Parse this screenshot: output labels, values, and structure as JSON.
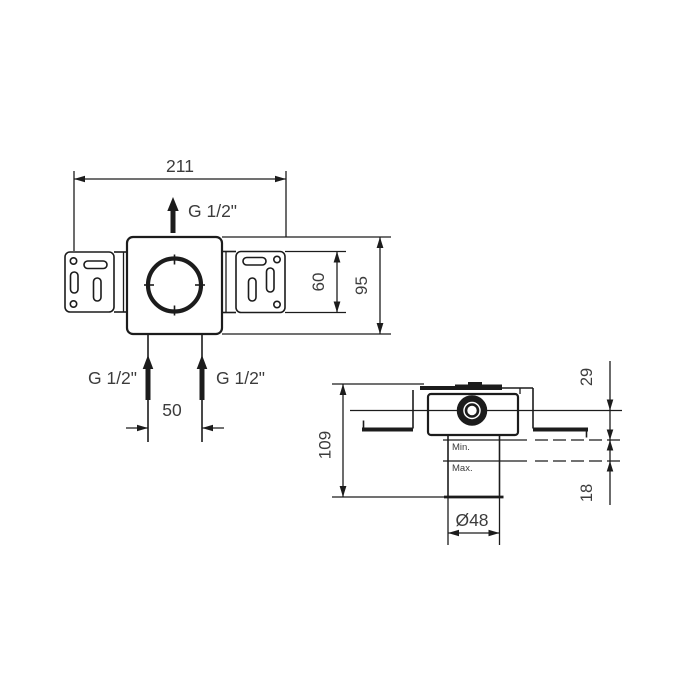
{
  "front_view": {
    "dims": {
      "overall_width": "211",
      "rail_height": "60",
      "body_height": "95",
      "inlet_spacing": "50"
    },
    "labels": {
      "top_outlet": "G 1/2\"",
      "left_inlet": "G 1/2\"",
      "right_inlet": "G 1/2\""
    }
  },
  "side_view": {
    "dims": {
      "total_depth": "109",
      "center_to_min": "29",
      "adjustment_range": "18",
      "pipe_diameter": "Ø48"
    },
    "labels": {
      "min": "Min.",
      "max": "Max."
    }
  },
  "colors": {
    "line": "#1c1c1c",
    "dim_text": "#3c3c3c",
    "background": "#ffffff"
  }
}
